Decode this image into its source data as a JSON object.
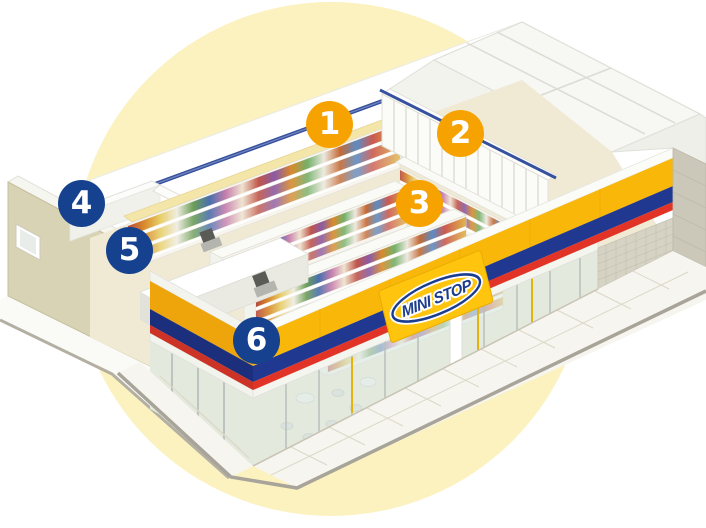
{
  "illustration": {
    "subject": "Isometric cutaway illustration of a MINISTOP convenience store with six numbered location markers",
    "background_shape": "large pale yellow circle"
  },
  "brand": {
    "logo_text": "MINI STOP"
  },
  "badges": [
    {
      "label": "1",
      "color_group": "orange"
    },
    {
      "label": "2",
      "color_group": "orange"
    },
    {
      "label": "3",
      "color_group": "orange"
    },
    {
      "label": "4",
      "color_group": "blue"
    },
    {
      "label": "5",
      "color_group": "blue"
    },
    {
      "label": "6",
      "color_group": "blue"
    }
  ],
  "colors": {
    "badge_orange": "#F6A200",
    "badge_blue": "#15418E",
    "background_circle": "#FBF2C0",
    "fascia_yellow": "#F9B70A",
    "stripe_blue": "#20388F",
    "stripe_red": "#E23426",
    "wall_tan": "#D8D3B4",
    "interior_blue_line": "#35509E",
    "floor": "#F0EAD5",
    "sign_yellow": "#FFC40D",
    "logo_blue": "#1C3C8E"
  }
}
